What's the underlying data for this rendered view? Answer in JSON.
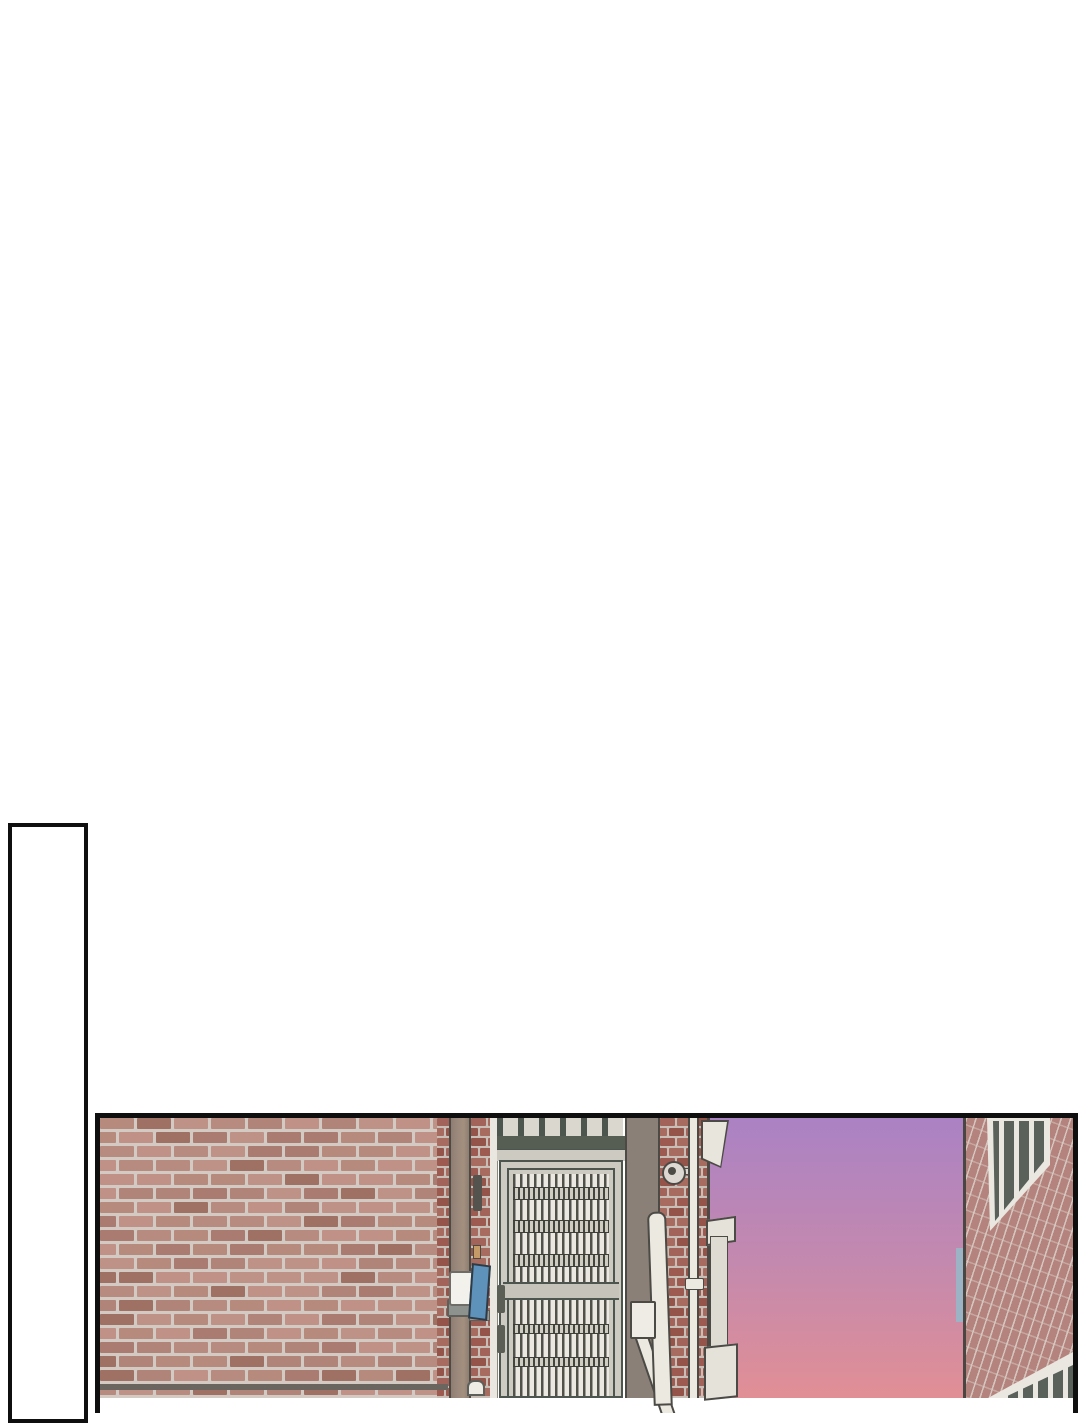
{
  "page": {
    "kind": "webtoon comic page, no text",
    "background": "#ffffff"
  },
  "colors": {
    "page_bg": "#ffffff",
    "panel_border": "#0f0f0f",
    "sky_top": "#ab82c4",
    "sky_mid": "#c489ae",
    "sky_bottom": "#e18f95",
    "outline": "#4c4a45",
    "wood": "#9a877b",
    "gate_light": "#cdcac1",
    "gate_dark": "#4d564e",
    "gate_beam": "#565e54",
    "bar_light": "#ebe8e1",
    "bar_dark": "#51514a",
    "rail_light": "#c6c3ba",
    "post_gray": "#8b8077",
    "pipe": "#ece9e1",
    "right_wall": "#b5837d",
    "glass": "#5a615a",
    "frame_white": "#e9e7e0",
    "sign_blue": "#5e92ba",
    "sliver_blue": "#9cb2c5"
  },
  "patterns": {
    "wall": {
      "brick_w": 34,
      "brick_h": 11,
      "mortar": 3,
      "seed": 11,
      "mortar_color": "#d2cac3",
      "tints": [
        "#b88b80",
        "#b1847a",
        "#bf9287",
        "#aa7b70",
        "#b78a7e",
        "#c09186",
        "#9f7064"
      ]
    },
    "red": {
      "brick_w": 15,
      "brick_h": 8,
      "mortar": 2,
      "seed": 5,
      "mortar_color": "#c9beb5",
      "tints": [
        "#9c5a50",
        "#a2645a",
        "#94544a",
        "#a86b60"
      ]
    }
  },
  "scene": {
    "empty_panel": "tall narrow empty panel, cut off at bottom of screen",
    "alley_panel": {
      "objects": [
        "pink brick wall",
        "wooden door post with wall lamp and blue sign plate",
        "metal security gate with vertical bars and transom grille",
        "dark gate post with intercom box",
        "red brick pillar with security camera and drain pipes",
        "white cornice and ledge post",
        "sunset gradient sky",
        "neighboring brick building seen in perspective with two dark windows"
      ]
    }
  }
}
